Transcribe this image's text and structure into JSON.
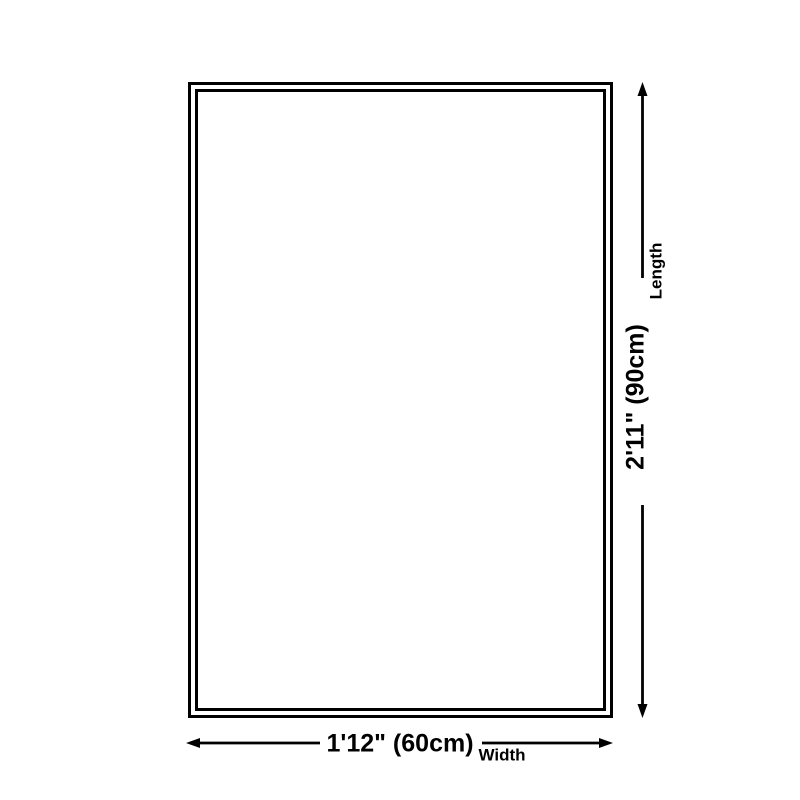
{
  "diagram": {
    "background_color": "#ffffff",
    "line_color": "#000000",
    "dimensions": {
      "length": {
        "value": "2'11\" (90cm)",
        "label": "Length"
      },
      "width": {
        "value": "1'12\" (60cm)",
        "label": "Width"
      }
    }
  }
}
